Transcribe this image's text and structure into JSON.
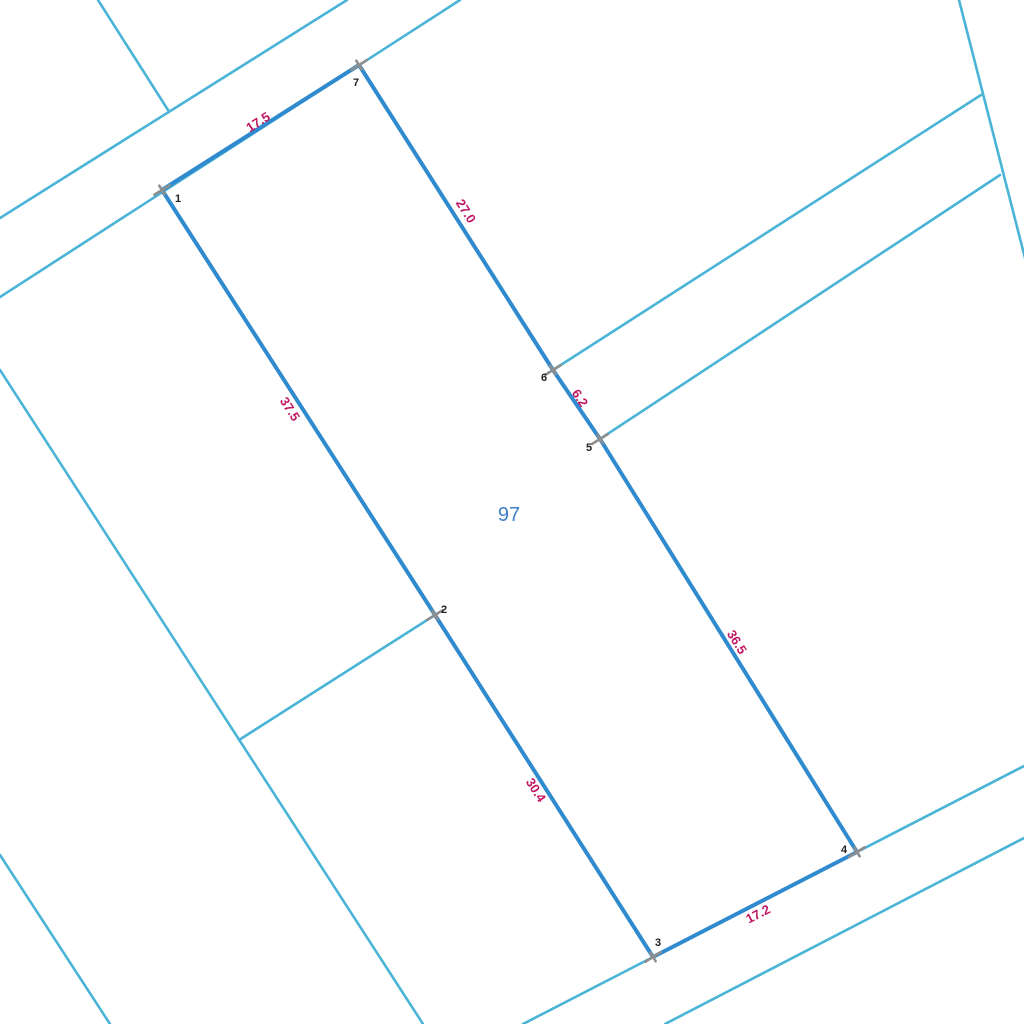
{
  "map": {
    "width": 1024,
    "height": 1024,
    "background_color": "#ffffff",
    "colors": {
      "parcel_boundary": "#2f8ace",
      "cadastre_line": "#4ab4d6",
      "measurement_text": "#c11663",
      "vertex_text": "#222222",
      "parcel_number_text": "#3d7fc6",
      "vertex_marker": "#8e8e8e"
    },
    "parcel": {
      "number": "97",
      "number_label": {
        "x": 509,
        "y": 515
      },
      "outline_order": [
        "1",
        "7",
        "6",
        "5",
        "4",
        "3",
        "2"
      ],
      "vertices": [
        {
          "n": "1",
          "x": 162,
          "y": 190,
          "label_x": 178,
          "label_y": 199
        },
        {
          "n": "2",
          "x": 435,
          "y": 615,
          "label_x": 444,
          "label_y": 610
        },
        {
          "n": "3",
          "x": 653,
          "y": 957,
          "label_x": 658,
          "label_y": 943
        },
        {
          "n": "4",
          "x": 857,
          "y": 852,
          "label_x": 844,
          "label_y": 850
        },
        {
          "n": "5",
          "x": 600,
          "y": 439,
          "label_x": 589,
          "label_y": 448
        },
        {
          "n": "6",
          "x": 553,
          "y": 370,
          "label_x": 544,
          "label_y": 378
        },
        {
          "n": "7",
          "x": 359,
          "y": 65,
          "label_x": 356,
          "label_y": 83
        }
      ],
      "edge_labels": [
        {
          "text": "17.5",
          "x": 258,
          "y": 122,
          "angle": -32.5
        },
        {
          "text": "27.0",
          "x": 466,
          "y": 211,
          "angle": 57.5
        },
        {
          "text": "6.2",
          "x": 580,
          "y": 398,
          "angle": 56.0
        },
        {
          "text": "36.5",
          "x": 737,
          "y": 642,
          "angle": 58.0
        },
        {
          "text": "17.2",
          "x": 758,
          "y": 914,
          "angle": -27.2
        },
        {
          "text": "30.4",
          "x": 536,
          "y": 790,
          "angle": 57.5
        },
        {
          "text": "37.5",
          "x": 290,
          "y": 409,
          "angle": 57.3
        }
      ]
    },
    "cadastre_lines": [
      {
        "name": "road-upper-edge-nw",
        "points": [
          [
            0,
            218
          ],
          [
            347,
            0
          ]
        ]
      },
      {
        "name": "road-lower-edge-nw",
        "points": [
          [
            0,
            297
          ],
          [
            460,
            0
          ]
        ]
      },
      {
        "name": "side-line-top-left",
        "points": [
          [
            98,
            0
          ],
          [
            168,
            110
          ]
        ]
      },
      {
        "name": "side-line-top-right",
        "points": [
          [
            959,
            0
          ],
          [
            1025,
            258
          ]
        ]
      },
      {
        "name": "branch-to-vertex-6",
        "points": [
          [
            981,
            95
          ],
          [
            553,
            370
          ]
        ]
      },
      {
        "name": "branch-to-vertex-5",
        "points": [
          [
            1000,
            175
          ],
          [
            600,
            439
          ]
        ]
      },
      {
        "name": "side-line-left",
        "points": [
          [
            0,
            370
          ],
          [
            423,
            1024
          ]
        ]
      },
      {
        "name": "branch-to-vertex-2",
        "points": [
          [
            239,
            740
          ],
          [
            435,
            615
          ]
        ]
      },
      {
        "name": "side-line-bottom-left",
        "points": [
          [
            0,
            855
          ],
          [
            110,
            1024
          ]
        ]
      },
      {
        "name": "road-upper-edge-se",
        "points": [
          [
            523,
            1024
          ],
          [
            1024,
            766
          ]
        ]
      },
      {
        "name": "road-lower-edge-se",
        "points": [
          [
            665,
            1024
          ],
          [
            1024,
            838
          ]
        ]
      }
    ],
    "marker": {
      "arm_long": 9,
      "arm_short": 5,
      "angle": -32,
      "stroke_width": 2.6
    },
    "line_widths": {
      "parcel_boundary": 4,
      "cadastre_line": 2.6
    }
  }
}
